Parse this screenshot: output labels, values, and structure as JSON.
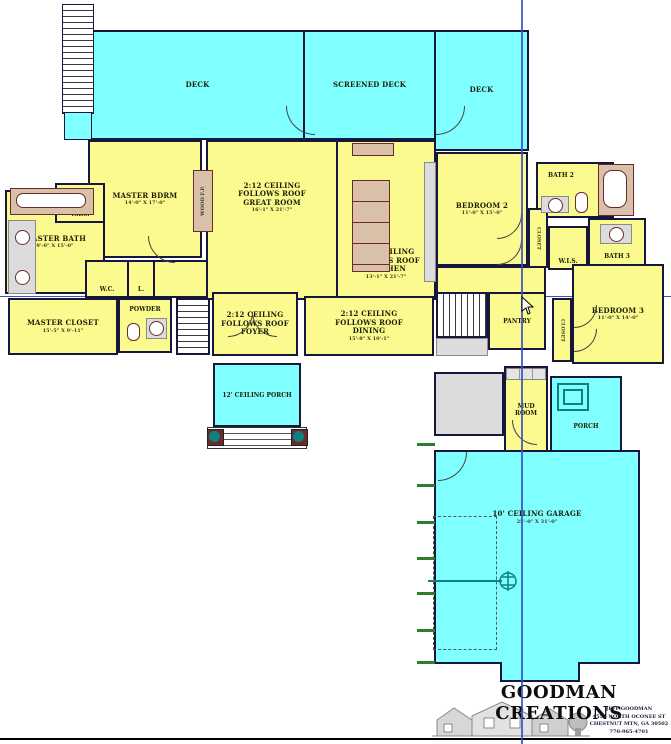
{
  "rooms": {
    "deck_left": {
      "name": "DECK"
    },
    "deck_screened": {
      "name": "SCREENED DECK"
    },
    "deck_right": {
      "name": "DECK"
    },
    "master_bdrm": {
      "name": "MASTER BDRM",
      "dims": "14'-0\" X 17'-0\""
    },
    "wood_fp": {
      "name": "WOOD F.P."
    },
    "great_room": {
      "ceiling": "2:12 CEILING",
      "roof": "FOLLOWS ROOF",
      "name": "GREAT ROOM",
      "dims": "16'-1\" X 21'-7\""
    },
    "kitchen": {
      "ceiling": "2:12 CEILING",
      "roof": "FOLLOWS ROOF",
      "name": "KITCHEN",
      "dims": "13'-1\" X 21'-7\""
    },
    "master_bath": {
      "name": "MASTER BATH",
      "dims": "9'-0\" X 15'-0\""
    },
    "wis_master": {
      "name": "W.I.S."
    },
    "wc": {
      "name": "W.C."
    },
    "linen": {
      "name": "L."
    },
    "master_closet": {
      "name": "MASTER CLOSET",
      "dims": "15'-5\" X 9'-11\""
    },
    "powder": {
      "name": "POWDER"
    },
    "foyer": {
      "ceiling": "2:12 CEILING",
      "roof": "FOLLOWS ROOF",
      "name": "FOYER"
    },
    "dining": {
      "ceiling": "2:12 CEILING",
      "roof": "FOLLOWS ROOF",
      "name": "DINING",
      "dims": "15'-8\" X 10'-1\""
    },
    "pantry": {
      "name": "PANTRY"
    },
    "bedroom2": {
      "name": "BEDROOM 2",
      "dims": "11'-0\" X 15'-0\""
    },
    "bath2": {
      "name": "BATH 2"
    },
    "closet_bed2": {
      "name": "CLOSET"
    },
    "wis_bath3": {
      "name": "W.I.S."
    },
    "bath3": {
      "name": "BATH 3"
    },
    "bedroom3": {
      "name": "BEDROOM 3",
      "dims": "11'-0\" X 14'-0\""
    },
    "closet_bed3": {
      "name": "CLOSET"
    },
    "porch_front": {
      "name": "12' CEILING PORCH"
    },
    "laundry": {
      "name": "LAUNDRY"
    },
    "mud_room": {
      "line1": "MUD",
      "line2": "ROOM"
    },
    "porch_rear": {
      "name": "PORCH"
    },
    "garage": {
      "name": "10' CEILING GARAGE",
      "dims": "25'-0\" X 31'-0\""
    }
  },
  "logo": {
    "title": "GOODMAN CREATIONS",
    "line1": "JEFF GOODMAN",
    "line2": "4550 NORTH OCONEE ST",
    "line3": "CHESTNUT MTN, GA 30502",
    "line4": "770-965-4701"
  },
  "colors": {
    "room_fill": "#FAFA8E",
    "deck_fill": "#7FFFFF",
    "wall": "#17173D",
    "fixture_maroon": "#6B2B2B",
    "guide_blue": "#3A50C8",
    "tick_green": "#2E7D2E",
    "column_teal": "#0E8080"
  }
}
